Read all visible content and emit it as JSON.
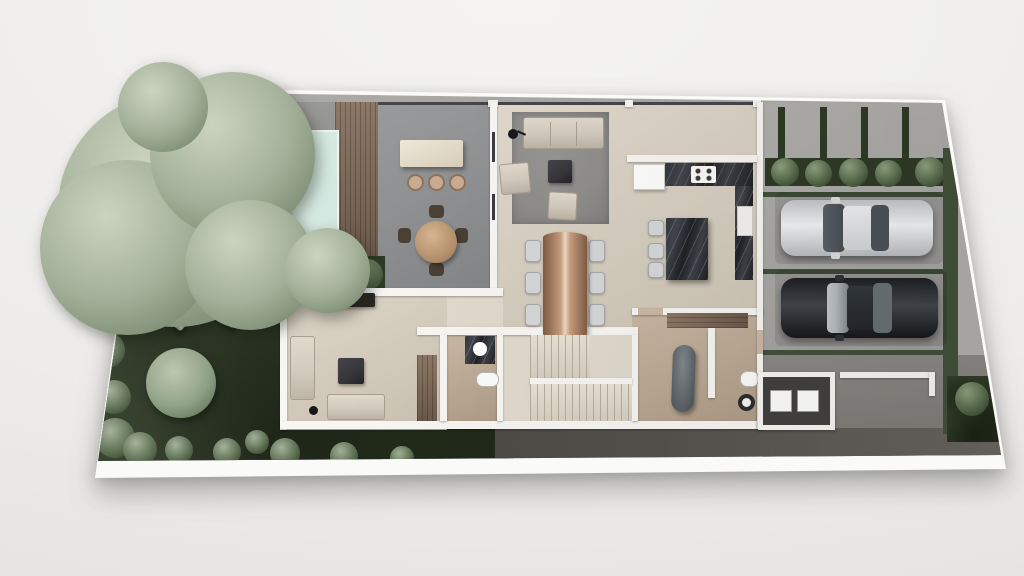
{
  "scene": {
    "type": "architectural-floor-plan-render",
    "view": "top-down-aerial",
    "canvas": {
      "width": 1024,
      "height": 576
    }
  },
  "colors": {
    "page_bg_a": "#f4f3f1",
    "page_bg_b": "#edecea",
    "page_bg_c": "#e3e2e0",
    "slab": "#fafaf8",
    "base": "#a9a8a5",
    "wall": "#f7f6f3",
    "patio": "#9d9d9b",
    "terrace": "#8f9092",
    "wood_a": "#8c7765",
    "wood_b": "#6b594a",
    "pool_a": "#cfe9e1",
    "pool_b": "#abd6ca",
    "ledge": "#edf4ee",
    "lawn_a": "#3a472f",
    "lawn_b": "#1f2818",
    "tree_hi": "#ccd4c0",
    "tree_mid": "#a3b099",
    "tree_lo": "#75866c",
    "bush_hi": "#90a37e",
    "bush_lo": "#55684a",
    "hedge_bed": "#2e3a26",
    "green_line": "#42513a",
    "floor_a": "#e0d9cc",
    "floor_b": "#cec5b5",
    "tan_a": "#c9b8a4",
    "tan_b": "#ae9c86",
    "marble_a": "#34373d",
    "marble_b": "#1f2125",
    "rug": "#8e8d8a",
    "sofa": "#d2cabd",
    "chair": "#d6d7d8",
    "dark_item": "#36363a",
    "table_a": "#c89d7d",
    "table_b": "#7e5c43",
    "seam": "#e8d6c2",
    "stair_tread": "#e8e2d6",
    "stair_line": "#b5ad9e",
    "garage": "#a6a5a3",
    "pavers": "#b2b0ad",
    "drive_mid": "#8b8885",
    "drive_dark": "#57534e",
    "utility": "#434140",
    "cream_a": "#efe8d8",
    "cream_b": "#d8cfba",
    "stool_tan": "#c9ad92",
    "tub_a": "#828a8e",
    "tub_b": "#54595d",
    "car_silver_a": "#f2f3f4",
    "car_silver_b": "#c3c6c9",
    "car_dark_a": "#42464b",
    "car_dark_b": "#1d2024",
    "glass_dark": "#474d54",
    "glass_light": "#b5babd"
  },
  "rooms": [
    {
      "name": "garden-lawn"
    },
    {
      "name": "swimming-pool"
    },
    {
      "name": "pool-deck"
    },
    {
      "name": "wood-deck"
    },
    {
      "name": "outdoor-terrace"
    },
    {
      "name": "living-room"
    },
    {
      "name": "dining-area"
    },
    {
      "name": "kitchen"
    },
    {
      "name": "media-room"
    },
    {
      "name": "bathroom-1"
    },
    {
      "name": "staircase"
    },
    {
      "name": "bathroom-2"
    },
    {
      "name": "utility-room"
    },
    {
      "name": "garage"
    },
    {
      "name": "driveway"
    }
  ],
  "furniture": [
    "large-tree",
    "round-bush",
    "shrubs",
    "sun-loungers",
    "hedge-planter",
    "bar-island",
    "bar-stools",
    "outdoor-round-table",
    "outdoor-chairs",
    "area-rug",
    "sofa",
    "armchairs",
    "coffee-table",
    "floor-lamp",
    "live-edge-dining-table",
    "dining-chairs",
    "fridge",
    "kitchen-counter",
    "stove",
    "oven-stack",
    "kitchen-island",
    "island-stools",
    "media-console",
    "stair-flights",
    "freestanding-bathtub",
    "toilets",
    "round-sinks",
    "vanity",
    "wood-closets",
    "washer",
    "dryer"
  ],
  "vehicles": [
    {
      "name": "silver-sedan"
    },
    {
      "name": "dark-gray-sedan"
    }
  ]
}
